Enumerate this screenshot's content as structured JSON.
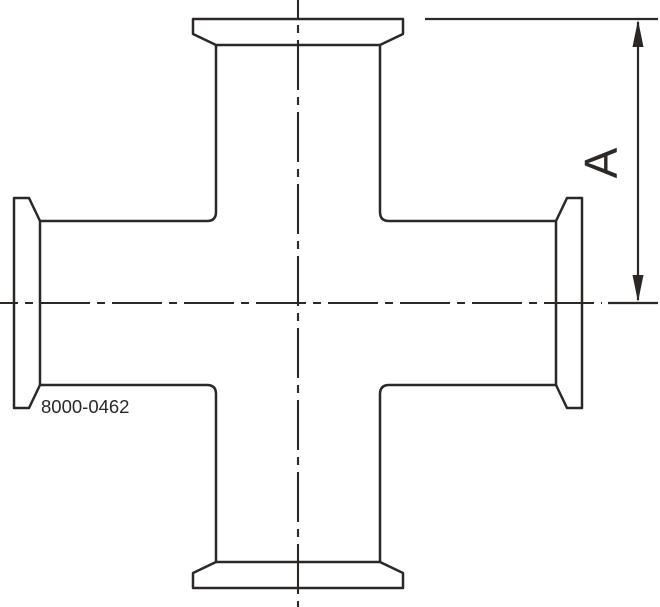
{
  "drawing": {
    "part_number": "8000-0462",
    "dimension_label": "A",
    "colors": {
      "line": "#2b2826",
      "background": "#ffffff"
    },
    "canvas": {
      "width": 660,
      "height": 607
    },
    "geometry": {
      "type": "cross-fitting-4-way-clamp-ends",
      "center": {
        "x": 298,
        "y": 303
      },
      "tube_outer_width_px": 164,
      "ferrule_lip_length_px": 210,
      "ferrule_lip_thickness_px": 15,
      "dimension_a_span_px": 284,
      "dimension_a_from": "top ferrule face",
      "dimension_a_to": "horizontal centerline"
    }
  }
}
